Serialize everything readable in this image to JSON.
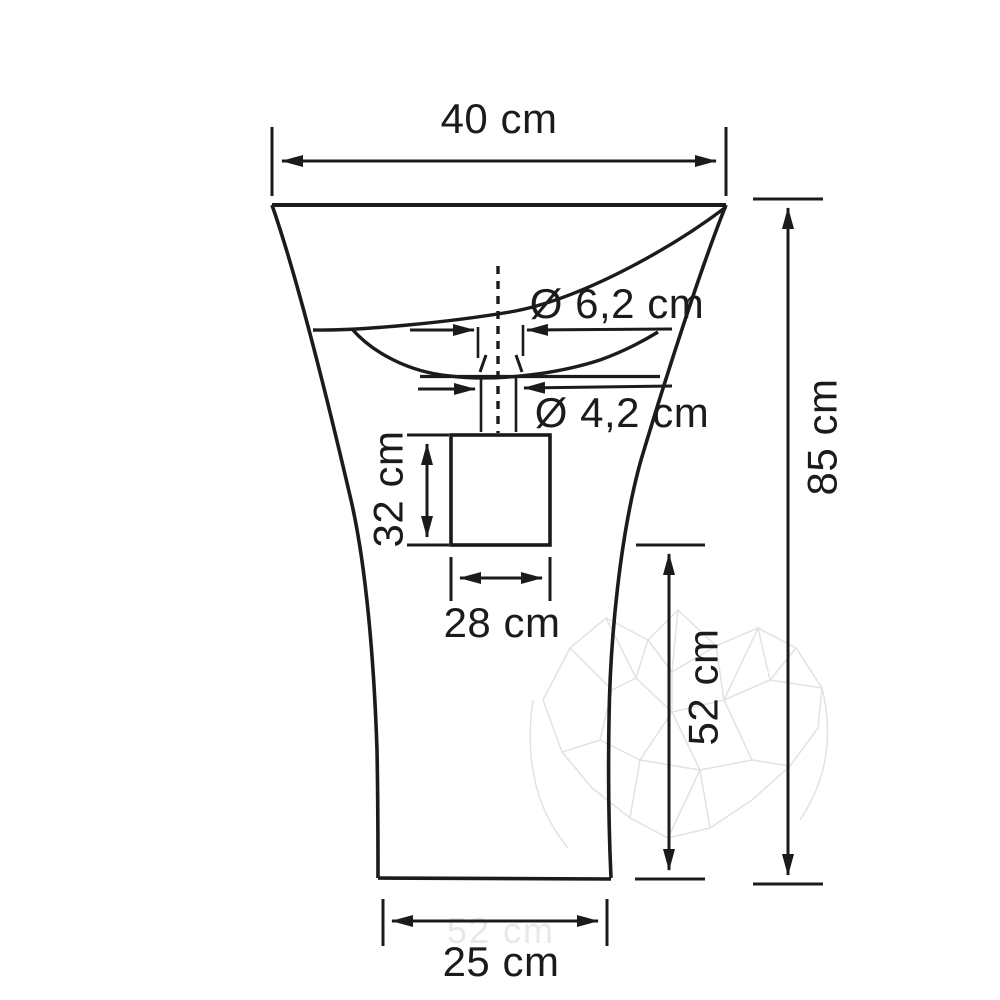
{
  "figure": {
    "type": "technical-dimension-drawing",
    "subject": "freestanding pedestal washbasin, front view"
  },
  "dimensions": {
    "overall_width": {
      "value": 40,
      "unit": "cm",
      "label": "40 cm"
    },
    "faucet_hole_diameter": {
      "value": 6.2,
      "unit": "cm",
      "label": "Ø 6,2 cm"
    },
    "drain_hole_diameter": {
      "value": 4.2,
      "unit": "cm",
      "label": "Ø 4,2 cm"
    },
    "cutout_height": {
      "value": 32,
      "unit": "cm",
      "label": "32 cm"
    },
    "cutout_width": {
      "value": 28,
      "unit": "cm",
      "label": "28 cm"
    },
    "basin_to_floor": {
      "value": 52,
      "unit": "cm",
      "label": "52 cm"
    },
    "overall_height": {
      "value": 85,
      "unit": "cm",
      "label": "85 cm"
    },
    "base_width": {
      "value": 25,
      "unit": "cm",
      "label": "25 cm"
    }
  },
  "watermark": {
    "ghost_label": "52 cm",
    "style": "low-poly mesh"
  },
  "colors": {
    "line": "#1b1b1b",
    "background": "#ffffff",
    "watermark": "#e2e2e2",
    "ghost_text": "#eae8e6"
  }
}
